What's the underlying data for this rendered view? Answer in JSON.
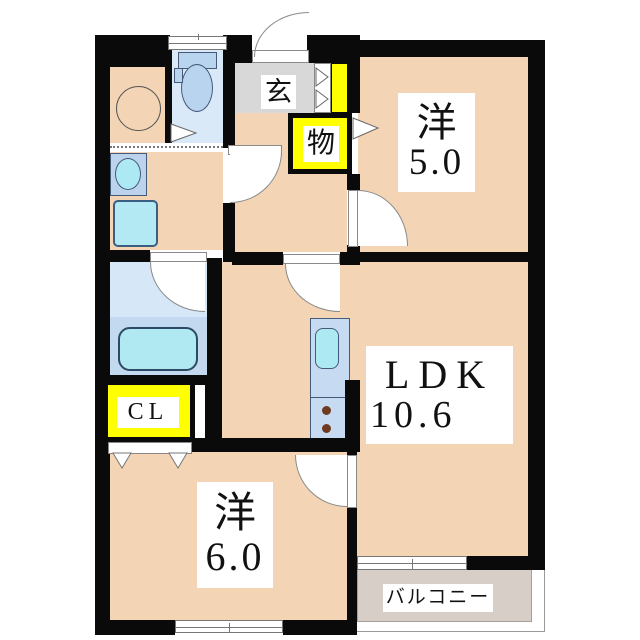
{
  "title": "apartment-floor-plan",
  "rooms": {
    "western5": {
      "name": "洋",
      "area": "5.0"
    },
    "ldk": {
      "name": "LDK",
      "area": "10.6"
    },
    "western6": {
      "name": "洋",
      "area": "6.0"
    },
    "entrance": {
      "name": "玄"
    },
    "storage": {
      "name": "物"
    },
    "closet": {
      "name": "CL"
    },
    "balcony": {
      "name": "バルコニー"
    }
  },
  "fixtures": {
    "toilet": "toilet-icon",
    "washbasin": "washbasin-icon",
    "washing_machine_pan": "washing-machine-pan-icon",
    "bathtub": "bathtub-icon",
    "kitchen_sink": "kitchen-sink-icon",
    "stove_burners": "stove-burner-icon",
    "round_fixture": "round-fixture-icon"
  },
  "colors": {
    "wall": "#0a0a0a",
    "floor": "#f3d5b5",
    "entrance_floor": "#d8d8d8",
    "balcony_floor": "#d7cfc7",
    "closet_highlight": "#ffff00",
    "water_fixture": "#b3e9f3",
    "cabinet_fixture": "#c2d8f0",
    "bath_floor": "#d6e8f8"
  }
}
